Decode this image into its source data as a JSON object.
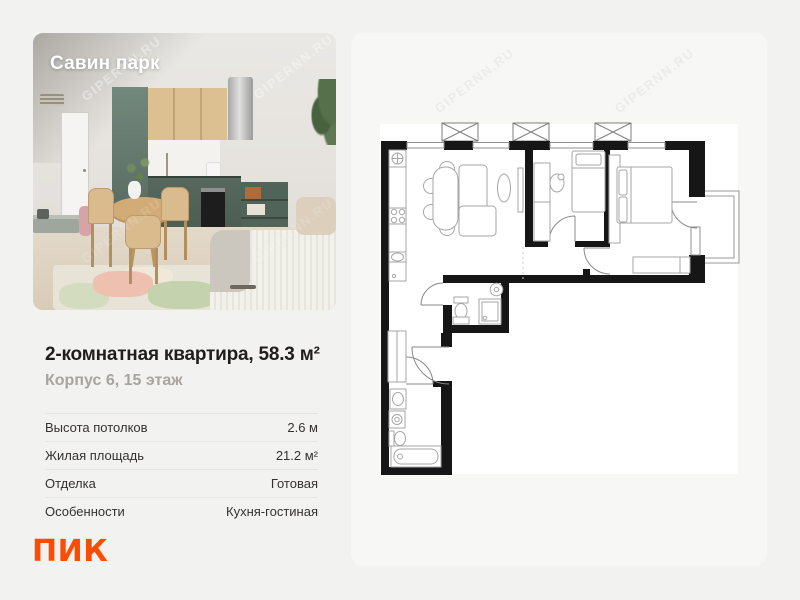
{
  "watermark": {
    "text": "GIPERNN.RU"
  },
  "photo": {
    "title": "Савин парк"
  },
  "listing": {
    "title": "2-комнатная квартира, 58.3 м²",
    "subtitle": "Корпус 6, 15 этаж"
  },
  "details": {
    "rows": [
      {
        "label": "Высота потолков",
        "value": "2.6 м"
      },
      {
        "label": "Жилая площадь",
        "value": "21.2 м²"
      },
      {
        "label": "Отделка",
        "value": "Готовая"
      },
      {
        "label": "Особенности",
        "value": "Кухня-гостиная"
      }
    ]
  },
  "brand": {
    "name": "ПИК",
    "color": "#FC4C02"
  }
}
